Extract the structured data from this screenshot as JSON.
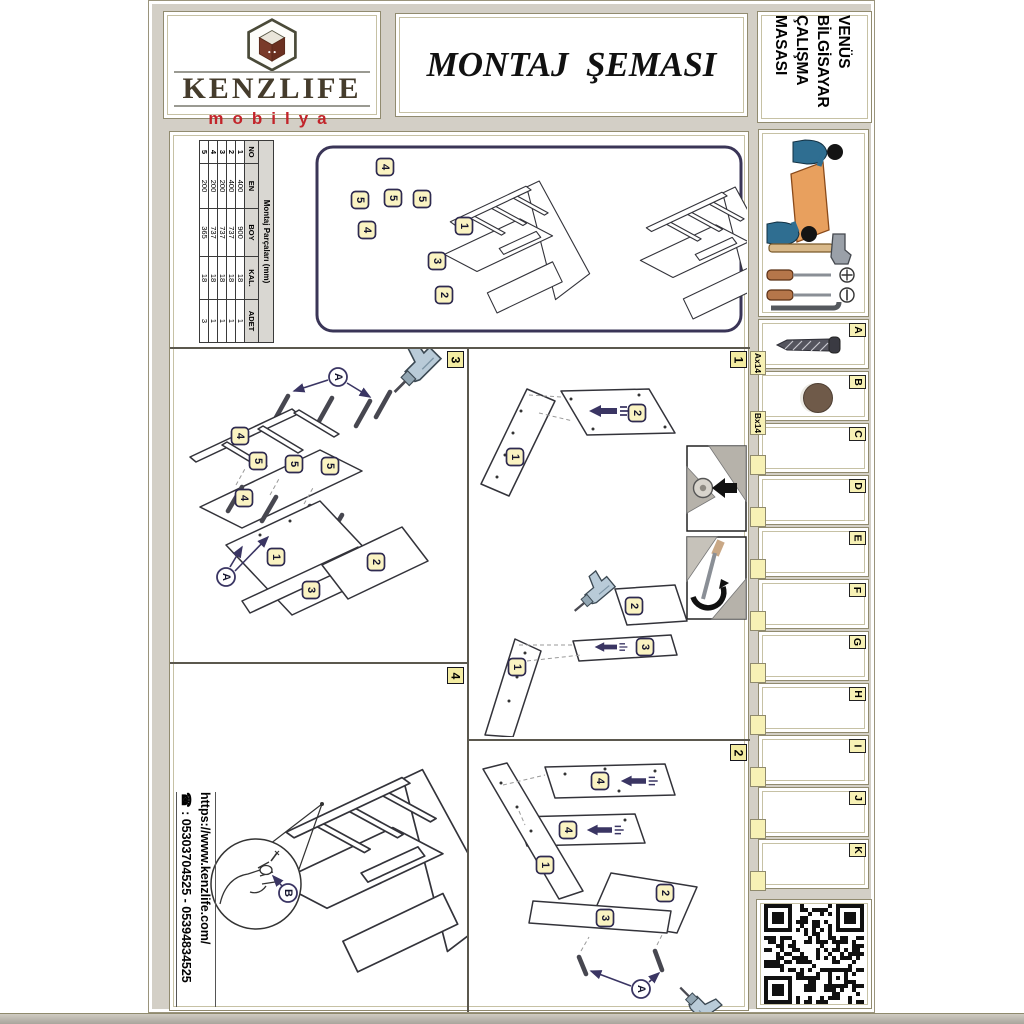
{
  "brand": {
    "name": "KENZLIFE",
    "tagline": "mobilya"
  },
  "header": {
    "title": "MONTAJ  ŞEMASI"
  },
  "product": {
    "lines": [
      "VENÜS",
      "BİLGİSAYAR",
      "ÇALIŞMA",
      "MASASI"
    ]
  },
  "contact": {
    "website": "https://www.kenzlife.com/",
    "phone_icon": "☎",
    "phone": ": 05303704525 - 05394834525"
  },
  "parts_table": {
    "title": "Montaj Parçaları (mm)",
    "headers": [
      "NO",
      "EN",
      "BOY",
      "KAL.",
      "ADET"
    ],
    "rows": [
      [
        "1",
        "400",
        "900",
        "18",
        "1"
      ],
      [
        "2",
        "400",
        "737",
        "18",
        "1"
      ],
      [
        "3",
        "200",
        "737",
        "18",
        "1"
      ],
      [
        "4",
        "200",
        "737",
        "18",
        "1"
      ],
      [
        "5",
        "200",
        "365",
        "18",
        "3"
      ]
    ]
  },
  "hardware": {
    "items": [
      {
        "letter": "A",
        "qty": "Ax14",
        "icon": "screw"
      },
      {
        "letter": "B",
        "qty": "Bx14",
        "icon": "cap"
      },
      {
        "letter": "C"
      },
      {
        "letter": "D"
      },
      {
        "letter": "E"
      },
      {
        "letter": "F"
      },
      {
        "letter": "G"
      },
      {
        "letter": "H"
      },
      {
        "letter": "I"
      },
      {
        "letter": "J"
      },
      {
        "letter": "K"
      }
    ]
  },
  "panels": {
    "overview_labels": [
      "4",
      "5",
      "5",
      "5",
      "4",
      "1",
      "3",
      "2"
    ],
    "step1": {
      "badge": "1",
      "labels": [
        "1",
        "2",
        "2",
        "3",
        "1"
      ]
    },
    "step2": {
      "badge": "2",
      "labels": [
        "4",
        "4",
        "1",
        "2",
        "3"
      ],
      "fastener": "A"
    },
    "step3": {
      "badge": "3",
      "labels": [
        "4",
        "5",
        "5",
        "5",
        "4",
        "1",
        "2",
        "3"
      ],
      "fastener": "A"
    },
    "step4": {
      "badge": "4",
      "fastener": "B"
    }
  },
  "colors": {
    "accent_yellow": "#f7f1b5",
    "navy": "#3a3563",
    "brand_red": "#c2242a",
    "border_tan": "#918b6f",
    "cap_brown": "#6f5a49"
  }
}
